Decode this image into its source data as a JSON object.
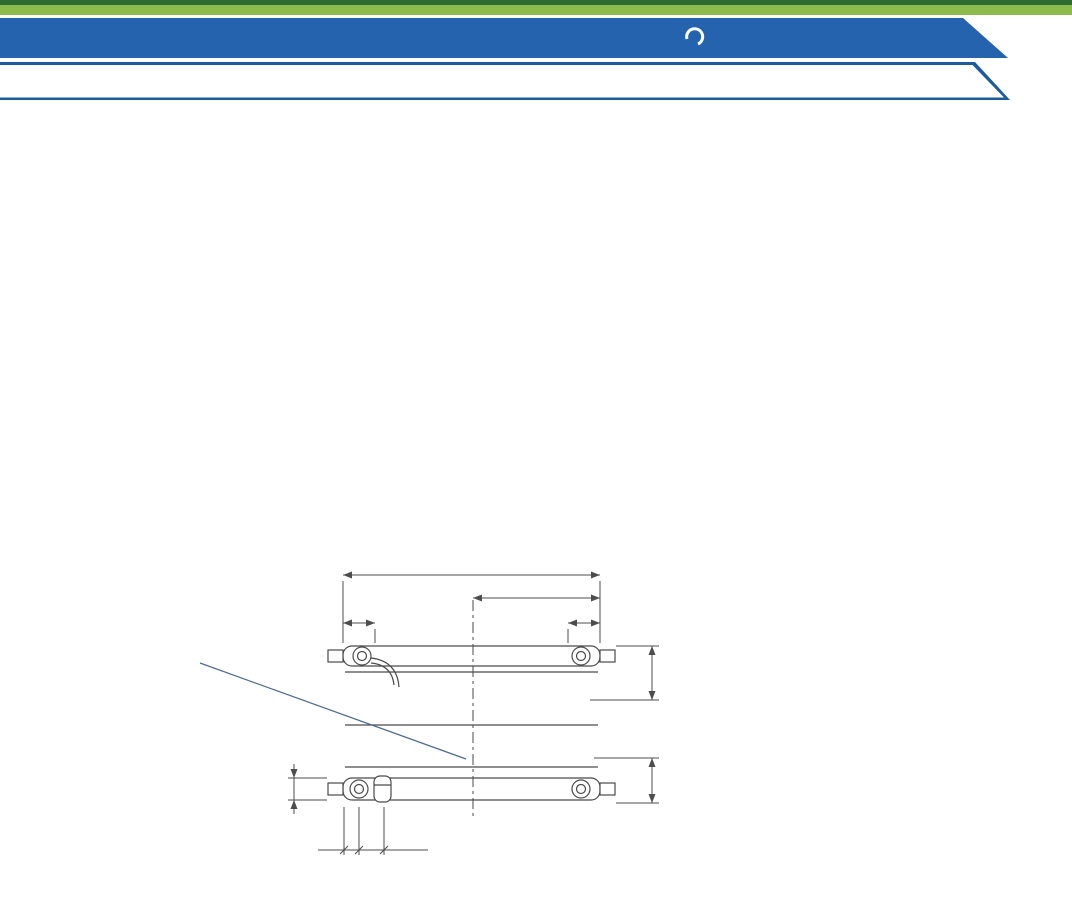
{
  "header": {
    "title": "ODLEGŁOŚCI MONTAŻOWE DLA GRZEJNIKÓW PŁYTOWYCH",
    "brand": "PERFEKT",
    "brand_sub": "SYSTEM",
    "subtitle": "ODLEGŁOŚCI MONTAŻOWE DLA GRZEJNIKÓW Z PODŁĄCZENIEM DOLNYM TYP V ,SV ,SLV",
    "colors": {
      "dark_green": "#2e6b31",
      "light_green": "#8cba4d",
      "banner_blue": "#2663ae",
      "border_blue": "#1d5c9c",
      "subtitle_text_blue": "#1e5fa6",
      "accent_blue": "#2d64a8"
    }
  },
  "common_dims": {
    "r": "R=H-55",
    "h": "H",
    "min": "min.100"
  },
  "diagrams": [
    {
      "label": "11V",
      "dim_wall": "17",
      "dim_width": "68",
      "dim_bottom": "48"
    },
    {
      "label": "21V",
      "dim_wall": "25",
      "dim_width": "71",
      "dim_bottom": "59"
    },
    {
      "label": "22V",
      "dim_wall": "25",
      "dim_width": "103",
      "dim_bottom": "75"
    },
    {
      "label": "33V",
      "dim_wall": "25",
      "dim_width": "157",
      "dim_bottom": "75"
    }
  ],
  "rear_view": {
    "dim_l": "L",
    "dim_l2": "L/2",
    "dim_a": "A",
    "g12": "G1/2",
    "dim_126": "126",
    "dim_27_5": "27.5",
    "dim_100": "100",
    "dim_30": "30",
    "dim_50": "50",
    "caption_prefix": "Widok grzejnika typ ",
    "caption_type": "11V",
    "caption_suffix": " od tyłu"
  },
  "notes": {
    "left": {
      "line1": "Środkowy zestaw uchwytów",
      "line2": "montowany jest dla grzejników",
      "line3": "od 1600mm długości włącznie"
    },
    "right": {
      "title": "Uwaga !",
      "paragraphs": [
        {
          "cls": "para",
          "segments": [
            {
              "t": "Grzejniki płytowe typ ",
              "b": false
            },
            {
              "t": "11V",
              "b": true
            },
            {
              "t": " oraz pozostałe wersje, ale kolorowe (patrz strona 16) grzejników z podłączeniem dolnym posiadają z tyłu przyspawane fabrycznie uchwyty i w tym przypadku wymiar A wynosi:",
              "b": false
            }
          ]
        },
        {
          "cls": "dla",
          "segments": [
            {
              "t": "dla ",
              "b": false
            },
            {
              "t": "11V",
              "b": true
            },
            {
              "t": " = 120mm",
              "b": false
            }
          ]
        },
        {
          "cls": "dla",
          "segments": [
            {
              "t": "dla ",
              "b": false
            },
            {
              "t": "21V/SV/SLV, 22V/SV/SLV, 33V/SV/SLV",
              "b": true
            },
            {
              "t": " = 100mm",
              "b": false
            }
          ]
        }
      ]
    }
  }
}
